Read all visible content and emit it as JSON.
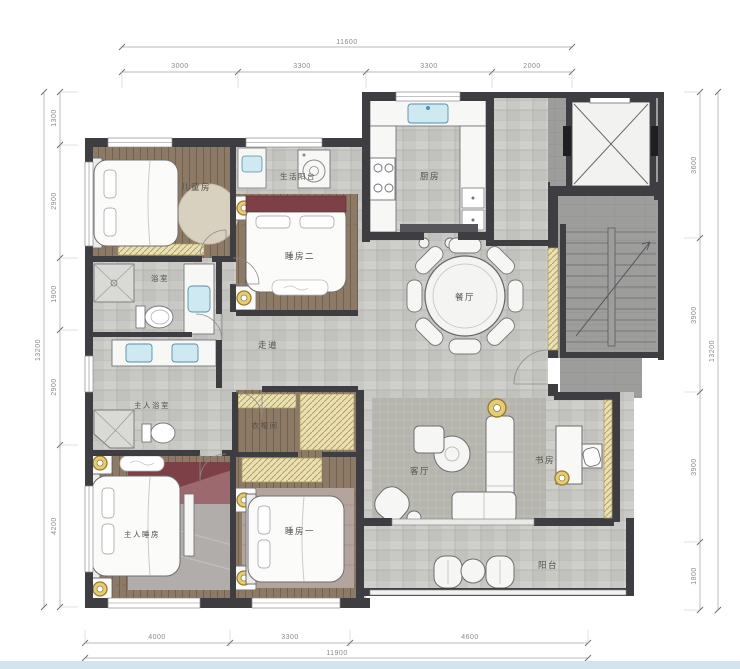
{
  "plan": {
    "type": "apartment-floor-plan",
    "rooms": {
      "children_room": "儿童房",
      "service_balcony": "生活阳台",
      "bedroom_two": "睡房二",
      "kitchen": "厨房",
      "dining_room": "餐厅",
      "corridor": "走道",
      "bathroom": "浴室",
      "master_bathroom": "主人浴室",
      "cloakroom": "衣帽间",
      "master_bedroom": "主人睡房",
      "bedroom_one": "睡房一",
      "living_room": "客厅",
      "study": "书房",
      "balcony": "阳台"
    },
    "dimensions": {
      "top": {
        "overall": "11600",
        "segments": [
          "3000",
          "3300",
          "3300",
          "2000"
        ]
      },
      "bottom": {
        "overall": "11900",
        "segments": [
          "4000",
          "3300",
          "4600"
        ]
      },
      "left": {
        "overall": "13200",
        "segments": [
          "1300",
          "2900",
          "1900",
          "2900",
          "4200"
        ]
      },
      "right": {
        "overall": "13200",
        "segments": [
          "3600",
          "3900",
          "3900",
          "1800"
        ]
      }
    },
    "colors": {
      "wall": "#3e3e42",
      "wood_floor": "#8d7a66",
      "tile_floor": "#c8c8c4",
      "core_gray": "#9d9d9b",
      "carpet": "#b5b5ae",
      "wardrobe_hatch": "#eae0b2",
      "accent_gold": "#e3cd7a",
      "accent_maroon": "#7d4046",
      "sink_blue": "#cfe9f2",
      "bottom_bar": "#d4e4ee"
    },
    "icons": [
      "bed-icon",
      "dining-table-icon",
      "sofa-icon",
      "coffee-table-icon",
      "desk-icon",
      "toilet-icon",
      "sink-icon",
      "shower-icon",
      "washer-icon",
      "stove-icon",
      "elevator-icon",
      "stairs-icon",
      "pendant-light-icon",
      "door-swing-icon",
      "lounge-chair-icon"
    ]
  }
}
